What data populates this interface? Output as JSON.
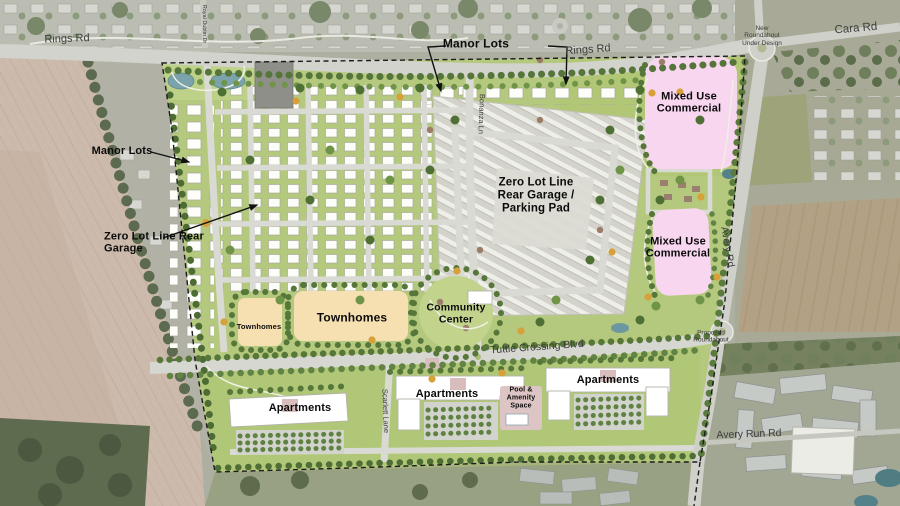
{
  "map": {
    "roads": {
      "rings_rd_west": "Rings Rd",
      "rings_rd_east": "Rings Rd",
      "cara_rd": "Cara Rd",
      "royal_dublin_dr": "Royal Dublin Dr",
      "bonanza_ln": "Bonanza Ln",
      "avery_rd": "Avery Rd",
      "tuttle_crossing_blvd": "Tuttle Crossing Blvd",
      "scarlett_lane": "Scarlett Lane",
      "avery_run_rd": "Avery Run Rd"
    },
    "annotations": {
      "new_roundabout": "New Roundabout Under Design",
      "proposed_roundabout": "Proposed Roundabout"
    },
    "areas": {
      "manor_lots_west": "Manor Lots",
      "manor_lots_north": "Manor Lots",
      "zero_lot_line_west": "Zero Lot Line Rear Garage",
      "zero_lot_line_center": "Zero Lot Line Rear Garage / Parking Pad",
      "mixed_use_north": "Mixed Use Commercial",
      "mixed_use_south": "Mixed Use Commercial",
      "townhomes_small": "Townhomes",
      "townhomes_large": "Townhomes",
      "community_center": "Community Center",
      "apartments_west": "Apartments",
      "apartments_center": "Apartments",
      "apartments_east": "Apartments",
      "pool_amenity": "Pool & Amenity Space"
    },
    "colors": {
      "mixed_use_commercial": "#f8d6ef",
      "townhomes": "#f6e0b2",
      "open_space_green": "#b5c97e",
      "road_gray": "#d6d7d1",
      "farmland_tan": "#ccbaac",
      "water_blue": "#76a0a8"
    }
  }
}
